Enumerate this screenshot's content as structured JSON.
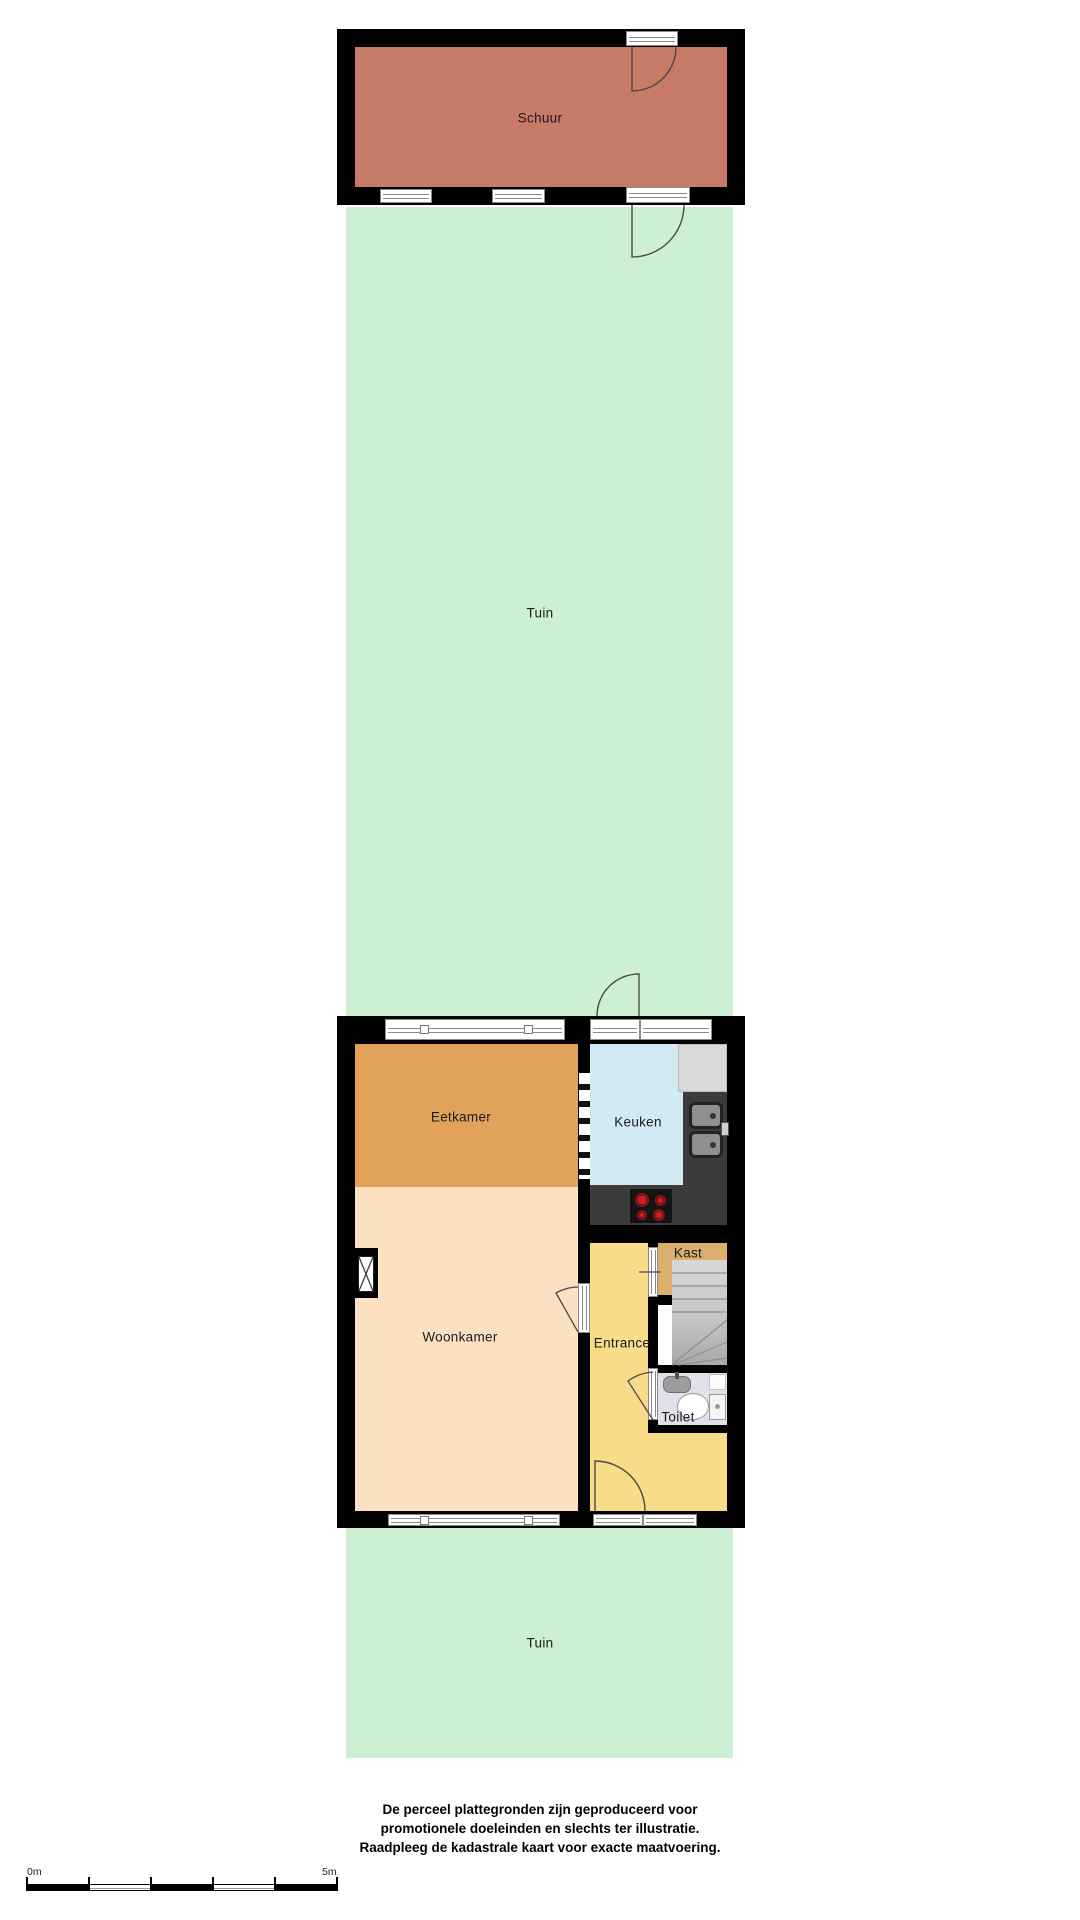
{
  "colors": {
    "wall": "#000000",
    "window_fill": "#ffffff",
    "window_line": "#8a8a8a",
    "door_arc": "#4a4a4a",
    "counter_dark": "#3b3b3b",
    "counter_light": "#d9d9d9",
    "sink_steel": "#8f8f8f",
    "cooktop": "#141414",
    "burner_red": "#cc2222",
    "stairs_dark": "#a8a8a8",
    "stairs_line": "#8f8f8f",
    "label_text": "#1b1b1b"
  },
  "rooms": {
    "schuur": {
      "label": "Schuur",
      "color": "#c87a69"
    },
    "tuin_top": {
      "label": "Tuin",
      "color": "#cdf0d3"
    },
    "eetkamer": {
      "label": "Eetkamer",
      "color": "#e2a25a"
    },
    "keuken": {
      "label": "Keuken",
      "color": "#d2eaf4"
    },
    "woonkamer": {
      "label": "Woonkamer",
      "color": "#fbe1c1"
    },
    "entrance": {
      "label": "Entrance",
      "color": "#f8dc8a"
    },
    "kast": {
      "label": "Kast",
      "color": "#dcaf6e"
    },
    "toilet": {
      "label": "Toilet",
      "color": "#e1e1eb"
    },
    "tuin_bottom": {
      "label": "Tuin",
      "color": "#cdf0d3"
    }
  },
  "disclaimer": {
    "lines": [
      "De perceel plattegronden zijn geproduceerd voor",
      "promotionele doeleinden en slechts ter illustratie.",
      "Raadpleeg de kadastrale kaart voor exacte maatvoering."
    ]
  },
  "scalebar": {
    "start_label": "0m",
    "end_label": "5m"
  }
}
